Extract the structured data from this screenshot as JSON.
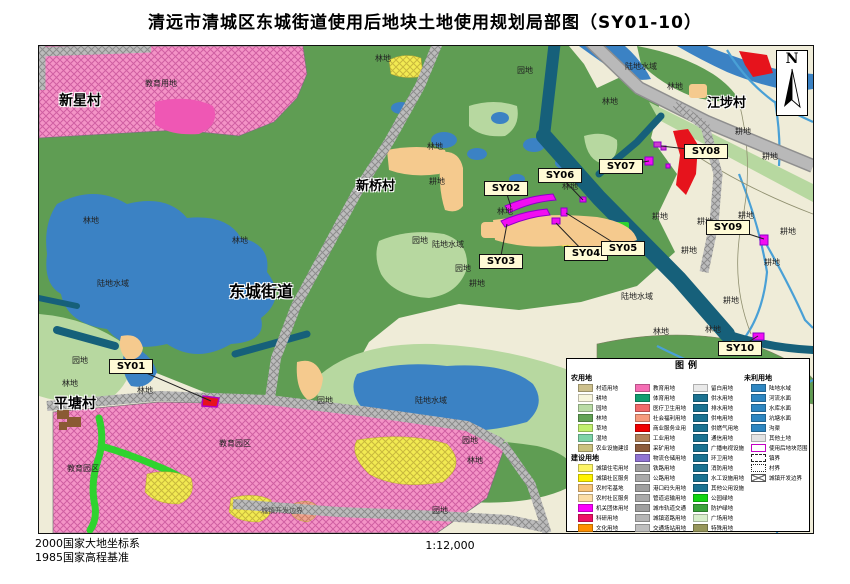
{
  "title": "清远市清城区东城街道使用后地块土地使用规划局部图（SY01-10）",
  "scale_text": "1:12,000",
  "datum1": "2000国家大地坐标系",
  "datum2": "1985国家高程基准",
  "north_label": "N",
  "legend": {
    "title": "图例",
    "columns": [
      {
        "sections": [
          {
            "header": "农用地",
            "items": [
              {
                "label": "村道用地",
                "color": "#cdc08c"
              },
              {
                "label": "耕地",
                "color": "#f7f5dc"
              },
              {
                "label": "园地",
                "color": "#b9dba4"
              },
              {
                "label": "林地",
                "color": "#63a355"
              },
              {
                "label": "草地",
                "color": "#c2f06e"
              },
              {
                "label": "湿地",
                "color": "#7ed3a7"
              },
              {
                "label": "农业设施建设用地",
                "color": "#cbc27f"
              }
            ]
          },
          {
            "header": "建设用地",
            "items": [
              {
                "label": "城镇住宅用地",
                "color": "#fdf566"
              },
              {
                "label": "城镇社区服务设施用地",
                "color": "#fff200"
              },
              {
                "label": "农村宅基地",
                "color": "#f7c579"
              },
              {
                "label": "农村社区服务设施用地",
                "color": "#fbdda6"
              },
              {
                "label": "机关团体用地",
                "color": "#fb00fb"
              },
              {
                "label": "科研用地",
                "color": "#ee1166"
              },
              {
                "label": "文化用地",
                "color": "#ff9000"
              }
            ]
          }
        ]
      },
      {
        "sections": [
          {
            "header": null,
            "items": [
              {
                "label": "教育用地",
                "color": "#f56eb4"
              },
              {
                "label": "体育用地",
                "color": "#109e70"
              },
              {
                "label": "医疗卫生用地",
                "color": "#f26a6a"
              },
              {
                "label": "社会福利用地",
                "color": "#f79b7d"
              },
              {
                "label": "商业服务业用地",
                "color": "#f00000"
              },
              {
                "label": "工业用地",
                "color": "#b1825a"
              },
              {
                "label": "采矿用地",
                "color": "#8c5c3c"
              },
              {
                "label": "物流仓储用地",
                "color": "#9073d2"
              },
              {
                "label": "铁路用地",
                "color": "#9f9f9f"
              },
              {
                "label": "公路用地",
                "color": "#a9a9a9"
              },
              {
                "label": "港口码头用地",
                "color": "#9f9f9f"
              },
              {
                "label": "管道运输用地",
                "color": "#a9a9a9"
              },
              {
                "label": "城市轨道交通用地",
                "color": "#9f9f9f"
              },
              {
                "label": "城镇道路用地",
                "color": "#b5b5b5"
              },
              {
                "label": "交通场站用地",
                "color": "#bfbfbf"
              }
            ]
          }
        ]
      },
      {
        "sections": [
          {
            "header": null,
            "items": [
              {
                "label": "留白用地",
                "color": "#e9e9e9"
              },
              {
                "label": "供水用地",
                "color": "#1b7291"
              },
              {
                "label": "排水用地",
                "color": "#1b7291"
              },
              {
                "label": "供电用地",
                "color": "#1b7291"
              },
              {
                "label": "供燃气用地",
                "color": "#1b7291"
              },
              {
                "label": "通信用地",
                "color": "#1b7291"
              },
              {
                "label": "广播电视设施用地",
                "color": "#1b7291"
              },
              {
                "label": "环卫用地",
                "color": "#1b7291"
              },
              {
                "label": "消防用地",
                "color": "#1b7291"
              },
              {
                "label": "水工设施用地",
                "color": "#1b7291"
              },
              {
                "label": "其他公用设施用地",
                "color": "#1b7291"
              },
              {
                "label": "公园绿地",
                "color": "#11d411"
              },
              {
                "label": "防护绿地",
                "color": "#3ba33b"
              },
              {
                "label": "广场用地",
                "color": "#d8eecb"
              },
              {
                "label": "特殊用地",
                "color": "#96965a"
              }
            ]
          }
        ]
      },
      {
        "sections": [
          {
            "header": "未利用地",
            "items": [
              {
                "label": "陆地水域",
                "color": "#2e86c1"
              },
              {
                "label": "河流水面",
                "color": "#2e86c1"
              },
              {
                "label": "水库水面",
                "color": "#2e86c1"
              },
              {
                "label": "坑塘水面",
                "color": "#2e86c1"
              },
              {
                "label": "沟渠",
                "color": "#2e86c1"
              },
              {
                "label": "其他土地",
                "color": "#e3e3e3"
              },
              {
                "label": "使用后地块范围",
                "swatch": "purple-outline"
              },
              {
                "label": "镇界",
                "swatch": "dashed"
              },
              {
                "label": "村界",
                "swatch": "dotted"
              },
              {
                "label": "城镇开发边界",
                "swatch": "cross"
              }
            ]
          }
        ]
      }
    ]
  },
  "map": {
    "villages": [
      {
        "t": "新星村",
        "x": 20,
        "y": 44,
        "size": 14
      },
      {
        "t": "新桥村",
        "x": 317,
        "y": 129,
        "size": 13
      },
      {
        "t": "江埗村",
        "x": 668,
        "y": 46,
        "size": 13
      },
      {
        "t": "平塘村",
        "x": 15,
        "y": 347,
        "size": 14
      },
      {
        "t": "东城街道",
        "x": 190,
        "y": 232,
        "size": 16
      }
    ],
    "area_labels": [
      {
        "t": "林地",
        "x": 44,
        "y": 170
      },
      {
        "t": "林地",
        "x": 193,
        "y": 190
      },
      {
        "t": "林地",
        "x": 336,
        "y": 8
      },
      {
        "t": "林地",
        "x": 388,
        "y": 96
      },
      {
        "t": "林地",
        "x": 458,
        "y": 161
      },
      {
        "t": "林地",
        "x": 523,
        "y": 136
      },
      {
        "t": "林地",
        "x": 563,
        "y": 51
      },
      {
        "t": "林地",
        "x": 628,
        "y": 36
      },
      {
        "t": "林地",
        "x": 98,
        "y": 340
      },
      {
        "t": "林地",
        "x": 23,
        "y": 333
      },
      {
        "t": "林地",
        "x": 614,
        "y": 281
      },
      {
        "t": "林地",
        "x": 666,
        "y": 279
      },
      {
        "t": "林地",
        "x": 428,
        "y": 410
      },
      {
        "t": "耕地",
        "x": 390,
        "y": 131
      },
      {
        "t": "耕地",
        "x": 613,
        "y": 166
      },
      {
        "t": "耕地",
        "x": 696,
        "y": 81
      },
      {
        "t": "耕地",
        "x": 723,
        "y": 106
      },
      {
        "t": "耕地",
        "x": 658,
        "y": 171
      },
      {
        "t": "耕地",
        "x": 741,
        "y": 181
      },
      {
        "t": "耕地",
        "x": 642,
        "y": 200
      },
      {
        "t": "耕地",
        "x": 725,
        "y": 212
      },
      {
        "t": "耕地",
        "x": 684,
        "y": 250
      },
      {
        "t": "耕地",
        "x": 699,
        "y": 165
      },
      {
        "t": "耕地",
        "x": 430,
        "y": 233
      },
      {
        "t": "园地",
        "x": 33,
        "y": 310
      },
      {
        "t": "园地",
        "x": 373,
        "y": 190
      },
      {
        "t": "园地",
        "x": 416,
        "y": 218
      },
      {
        "t": "园地",
        "x": 278,
        "y": 350
      },
      {
        "t": "园地",
        "x": 423,
        "y": 390
      },
      {
        "t": "园地",
        "x": 393,
        "y": 460
      },
      {
        "t": "园地",
        "x": 478,
        "y": 20
      },
      {
        "t": "陆地水域",
        "x": 58,
        "y": 233
      },
      {
        "t": "陆地水域",
        "x": 393,
        "y": 194
      },
      {
        "t": "陆地水域",
        "x": 582,
        "y": 246
      },
      {
        "t": "陆地水域",
        "x": 376,
        "y": 350
      },
      {
        "t": "陆地水域",
        "x": 586,
        "y": 16
      },
      {
        "t": "教育用地",
        "x": 106,
        "y": 33
      },
      {
        "t": "教育园区",
        "x": 28,
        "y": 418
      },
      {
        "t": "教育园区",
        "x": 180,
        "y": 393
      },
      {
        "t": "城镇开发边界",
        "x": 222,
        "y": 461,
        "s": "boundary"
      }
    ],
    "callouts": [
      {
        "id": "SY01",
        "bx": 70,
        "by": 313,
        "tx": 172,
        "ty": 355
      },
      {
        "id": "SY02",
        "bx": 445,
        "by": 135,
        "tx": 472,
        "ty": 161
      },
      {
        "id": "SY03",
        "bx": 440,
        "by": 208,
        "tx": 468,
        "ty": 178
      },
      {
        "id": "SY04",
        "bx": 525,
        "by": 200,
        "tx": 517,
        "ty": 177
      },
      {
        "id": "SY05",
        "bx": 562,
        "by": 195,
        "tx": 527,
        "ty": 167
      },
      {
        "id": "SY06",
        "bx": 499,
        "by": 122,
        "tx": 544,
        "ty": 154
      },
      {
        "id": "SY07",
        "bx": 560,
        "by": 113,
        "tx": 610,
        "ty": 115
      },
      {
        "id": "SY08",
        "bx": 645,
        "by": 98,
        "tx": 622,
        "ty": 100
      },
      {
        "id": "SY09",
        "bx": 667,
        "by": 174,
        "tx": 725,
        "ty": 193
      },
      {
        "id": "SY10",
        "bx": 679,
        "by": 295,
        "tx": 719,
        "ty": 290
      }
    ]
  }
}
